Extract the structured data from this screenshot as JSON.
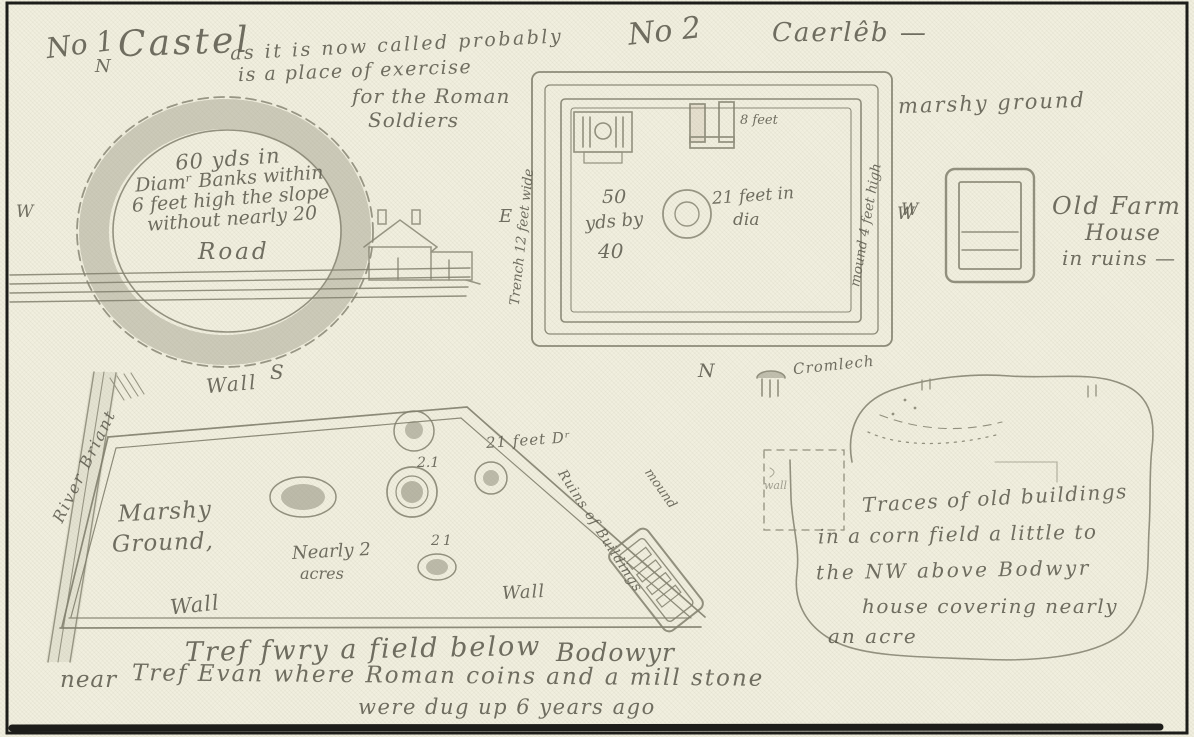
{
  "page": {
    "paper_color": "#f1efdf",
    "ink_color": "#5e5c4f",
    "pencil_color": "#82806e",
    "frame_color": "#1d1d1a"
  },
  "icons": {
    "house": "house-icon",
    "cromlech": "cromlech-icon"
  },
  "s1": {
    "no": "No 1",
    "n": "N",
    "title": "Castel",
    "sub": "as it is now called probably",
    "note1": "is a place of exercise",
    "note2": "for the Roman",
    "note3": "Soldiers",
    "c1": "60 yds in",
    "c2": "Diamʳ Banks within",
    "c3": "6 feet high the slope",
    "c4": "without nearly 20",
    "road": "Road",
    "w": "W",
    "wall": "Wall",
    "s": "S"
  },
  "s2": {
    "no": "No 2",
    "title": "Caerlêb —",
    "marshy": "marshy ground",
    "e": "E",
    "w": "W",
    "n": "N",
    "trench": "Trench 12 feet wide",
    "mound": "mound 4 feet high",
    "d1": "50",
    "d2": "yds by",
    "d3": "40",
    "pit1": "21 feet in",
    "pit2": "dia",
    "eight": "8 feet",
    "cromlech": "Cromlech"
  },
  "farm": {
    "w": "W",
    "l1": "Old Farm",
    "l2": "House",
    "l3": "in ruins —"
  },
  "f": {
    "river": "River Briant",
    "m1": "Marshy",
    "m2": "Ground,",
    "a1": "Nearly 2",
    "a2": "acres",
    "wall_left": "Wall",
    "wall_right": "Wall",
    "n21a": "2.1",
    "feetdr": "21 feet Dʳ",
    "n21b": "21",
    "ruins": "Ruins of Buildings",
    "mound": "mound",
    "cap1": "Tref fwry a field below",
    "cap1b": "Bodowyr",
    "cap2": "near",
    "cap2b": "Tref Evan where Roman coins and a mill stone",
    "cap3": "were dug up 6 years ago"
  },
  "corn": {
    "wallmark": "wall",
    "l1": "Traces of old buildings",
    "l2": "in a corn field a little to",
    "l3": "the NW above Bodwyr",
    "l4": "house covering nearly",
    "l5": "an acre"
  }
}
